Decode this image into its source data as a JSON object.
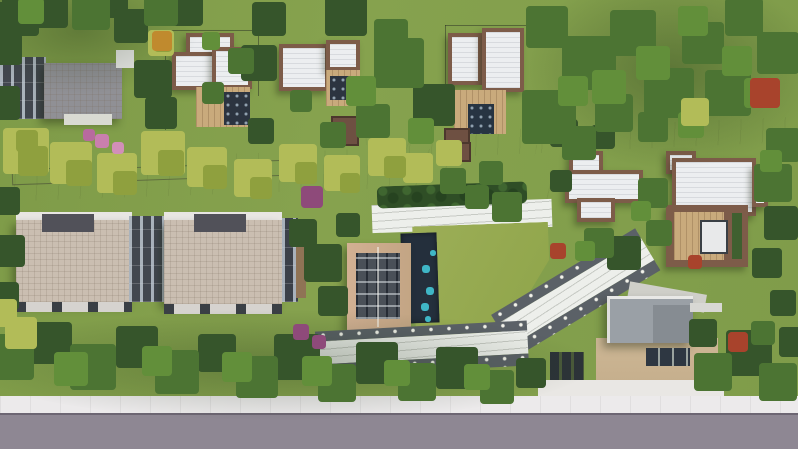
{
  "scene": {
    "title": "Aerial 3D render of a residential villa development",
    "description": "Top-down architectural visualization: brown-trimmed white-roof villas, two tan-roof apartment blocks, central lawn courtyard with pool pavilion, stepped promenade, tree-lined pedestrian paths and a gray street along the bottom edge",
    "palette": {
      "base_grass": "#84a04c",
      "bright_lawn": "#97aa52",
      "tree_dark": "#36552b",
      "tree_mid": "#4c7433",
      "tree_yellow": "#b2bc58",
      "path_white": "#edece8",
      "promenade_dark": "#5b6167",
      "road_gray": "#8e8793",
      "sidewalk_white": "#eceaeb",
      "roof_tan": "#cabeb1",
      "roof_white": "#eceef0",
      "trim_brown": "#7d5c49",
      "wood_deck": "#c9aa7c",
      "pool_navy": "#242f3c",
      "pool_teal": "#3fb6c6",
      "clubhouse_roof": "#c9ad90",
      "facade_dark": "#42474f",
      "forecourt_beige": "#cdb795",
      "accent_red": "#a8432c",
      "accent_purple": "#8e4a7a"
    },
    "regions": {
      "road": {
        "label": "Street along bottom edge"
      },
      "sidewalk": {
        "label": "Sidewalk"
      },
      "driveway": {
        "label": "Entrance driveway"
      },
      "gatehouse": {
        "label": "Entrance gatehouse"
      },
      "forecourt": {
        "label": "Entrance forecourt"
      },
      "lawn": {
        "label": "Central lawn courtyard"
      },
      "pool_deck": {
        "label": "Pool deck with loungers"
      },
      "clubhouse": {
        "label": "Clubhouse pavilion with skylight roof"
      },
      "promenade": {
        "label": "Stepped promenade with path lights"
      },
      "main_path": {
        "label": "Tree-lined pedestrian path"
      },
      "fork_path": {
        "label": "Upper pedestrian path"
      },
      "hedge": {
        "label": "Hedge row"
      },
      "apartments_west": {
        "label": "Apartment block (west)"
      },
      "apartments_east": {
        "label": "Apartment block (east)"
      },
      "rowhouse": {
        "label": "Row building (north-west)"
      },
      "villa_a": {
        "label": "Villa A"
      },
      "villa_b": {
        "label": "Villa B"
      },
      "villa_c": {
        "label": "Villa C"
      },
      "villa_d": {
        "label": "Villa D"
      },
      "villa_e": {
        "label": "Villa E with roof deck"
      },
      "trees": {
        "label": "Tree canopy"
      }
    }
  }
}
